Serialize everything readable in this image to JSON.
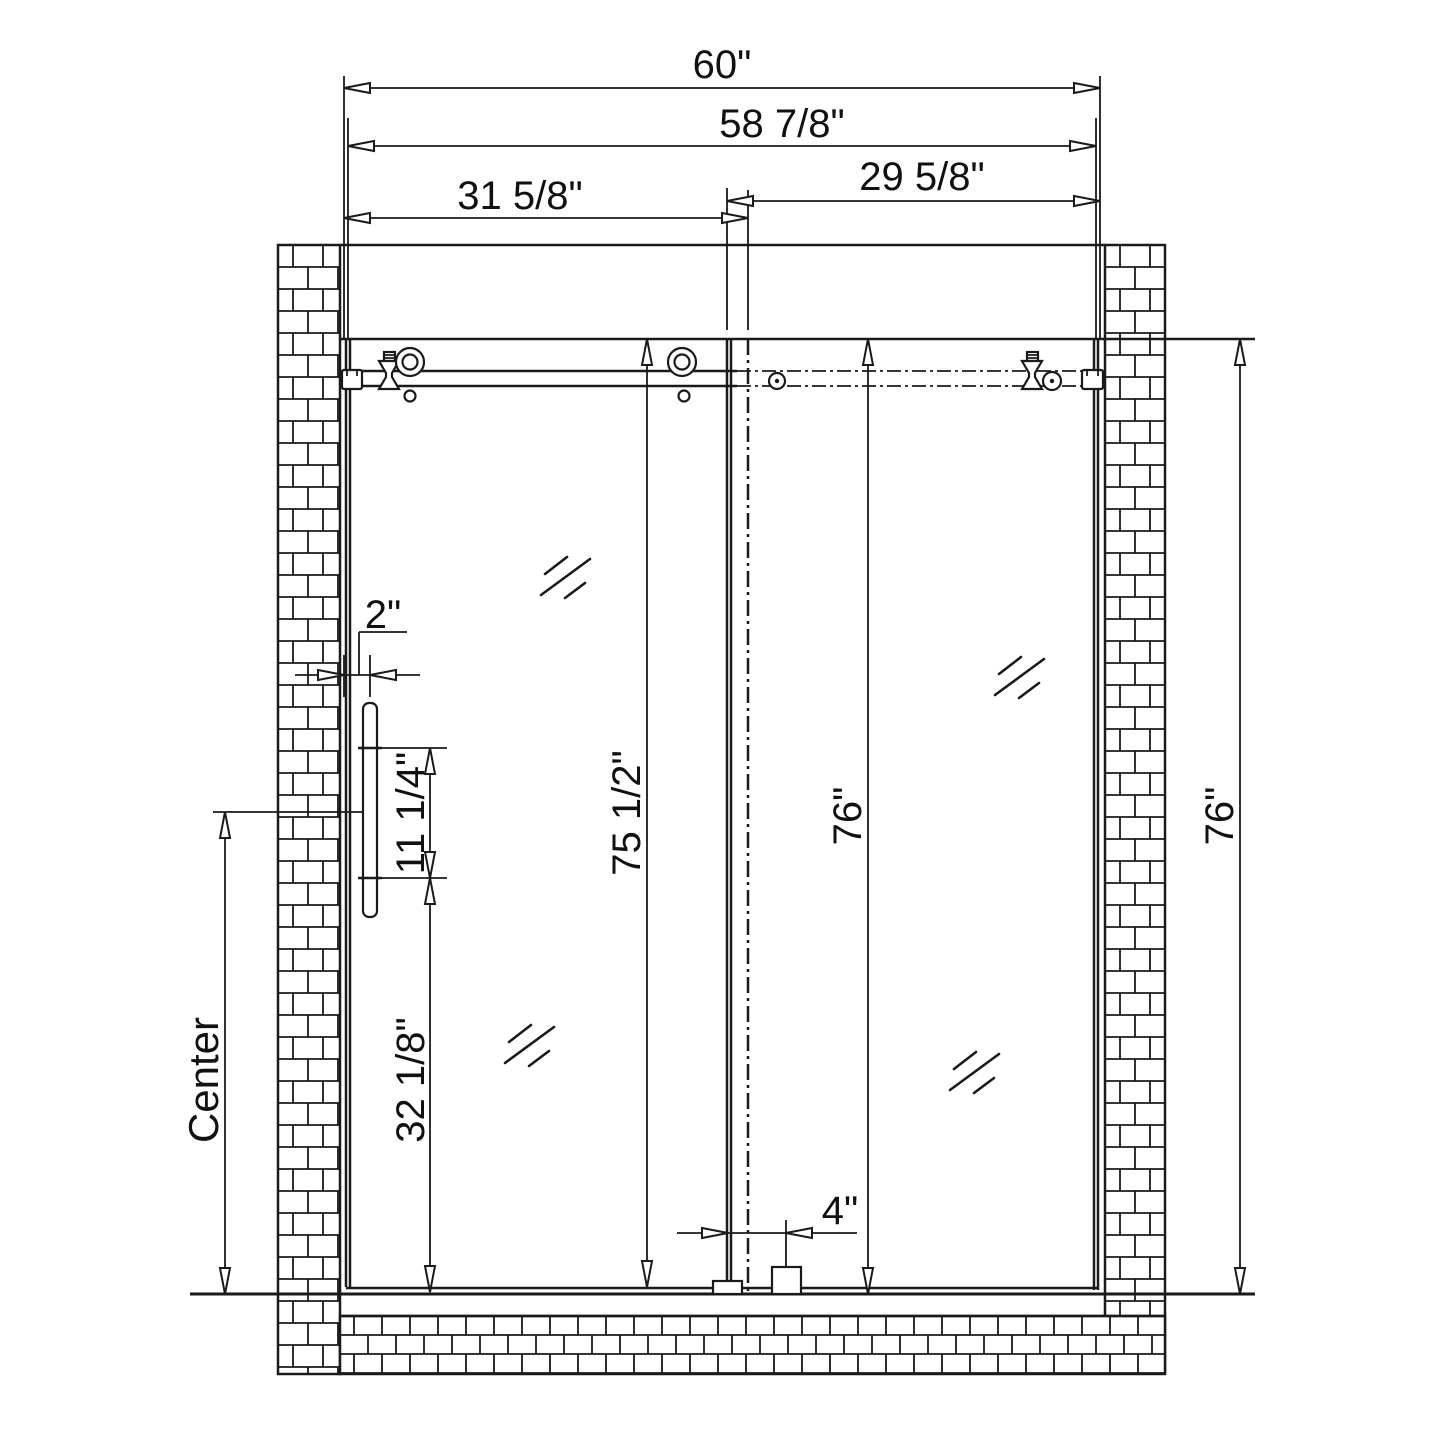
{
  "drawing": {
    "title": "Sliding shower door installation dimension drawing",
    "dims": {
      "overall_width": "60\"",
      "glass_width": "58 7/8\"",
      "left_panel_width": "31 5/8\"",
      "right_panel_width": "29 5/8\"",
      "handle_offset": "2\"",
      "handle_hole_spacing": "11 1/4\"",
      "handle_center_height": "32 1/8\"",
      "door_height": "75 1/2\"",
      "panel_height": "76\"",
      "opening_height": "76\"",
      "bottom_guide_offset": "4\"",
      "center_label": "Center"
    }
  }
}
